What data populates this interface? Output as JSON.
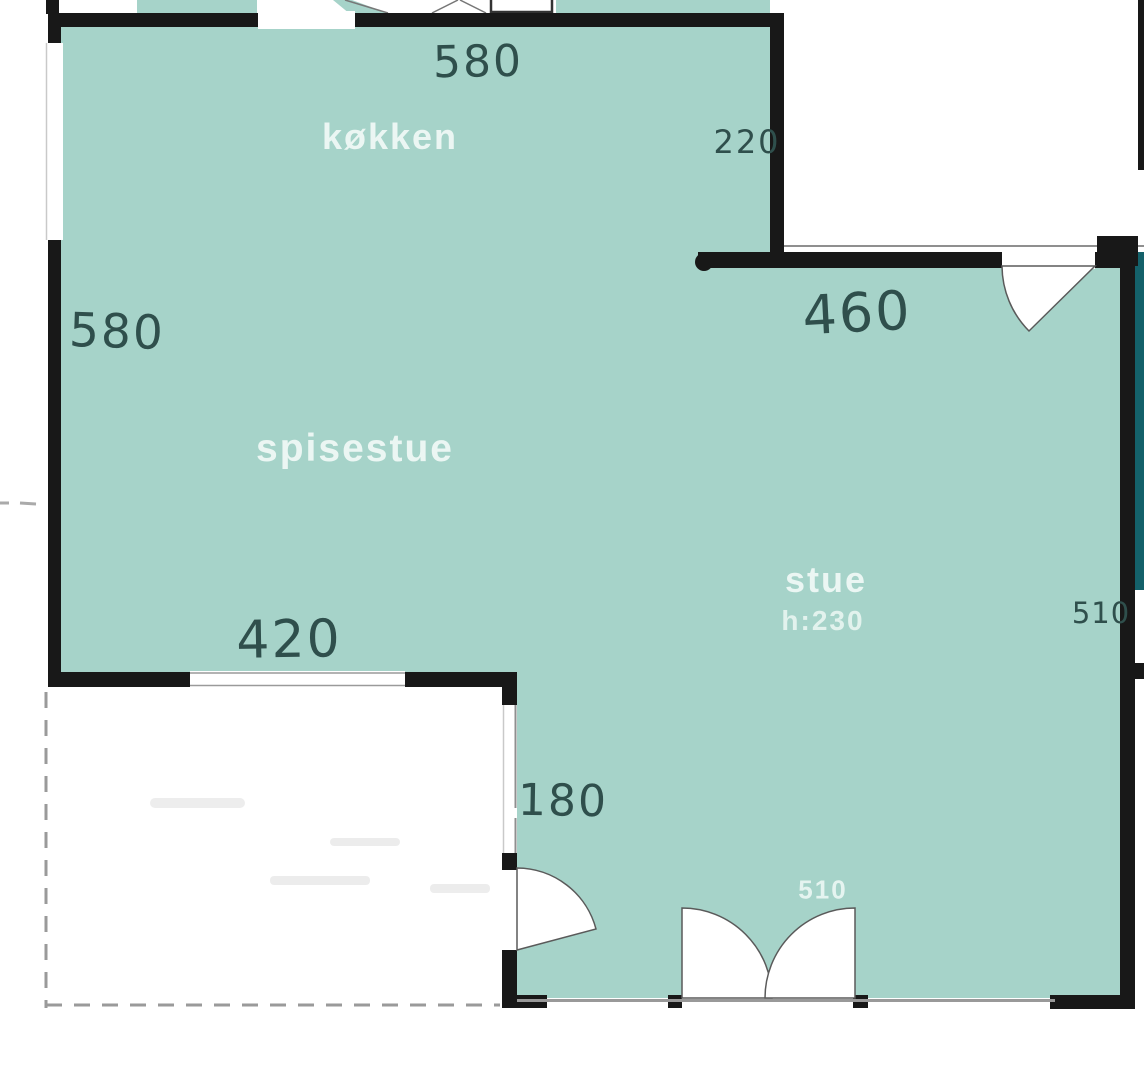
{
  "colors": {
    "room_fill": "#a6d3c9",
    "dark_room_fill": "#14616a",
    "wall": "#181818",
    "thin_line": "#8f8f8f",
    "handwriting": "#2f4f4c",
    "room_label": "#f1faf7"
  },
  "rooms": [
    {
      "name": "køkken"
    },
    {
      "name": "spisestue"
    },
    {
      "name": "stue",
      "ceiling_height": "h:230"
    }
  ],
  "measurements": {
    "kokken_top_width": "580",
    "passage_width": "220",
    "spisestue_left_height": "580",
    "stue_top_width": "460",
    "spisestue_bottom_width": "420",
    "stue_left_door": "180",
    "stue_bottom_door": "510",
    "stue_right_height": "510"
  }
}
